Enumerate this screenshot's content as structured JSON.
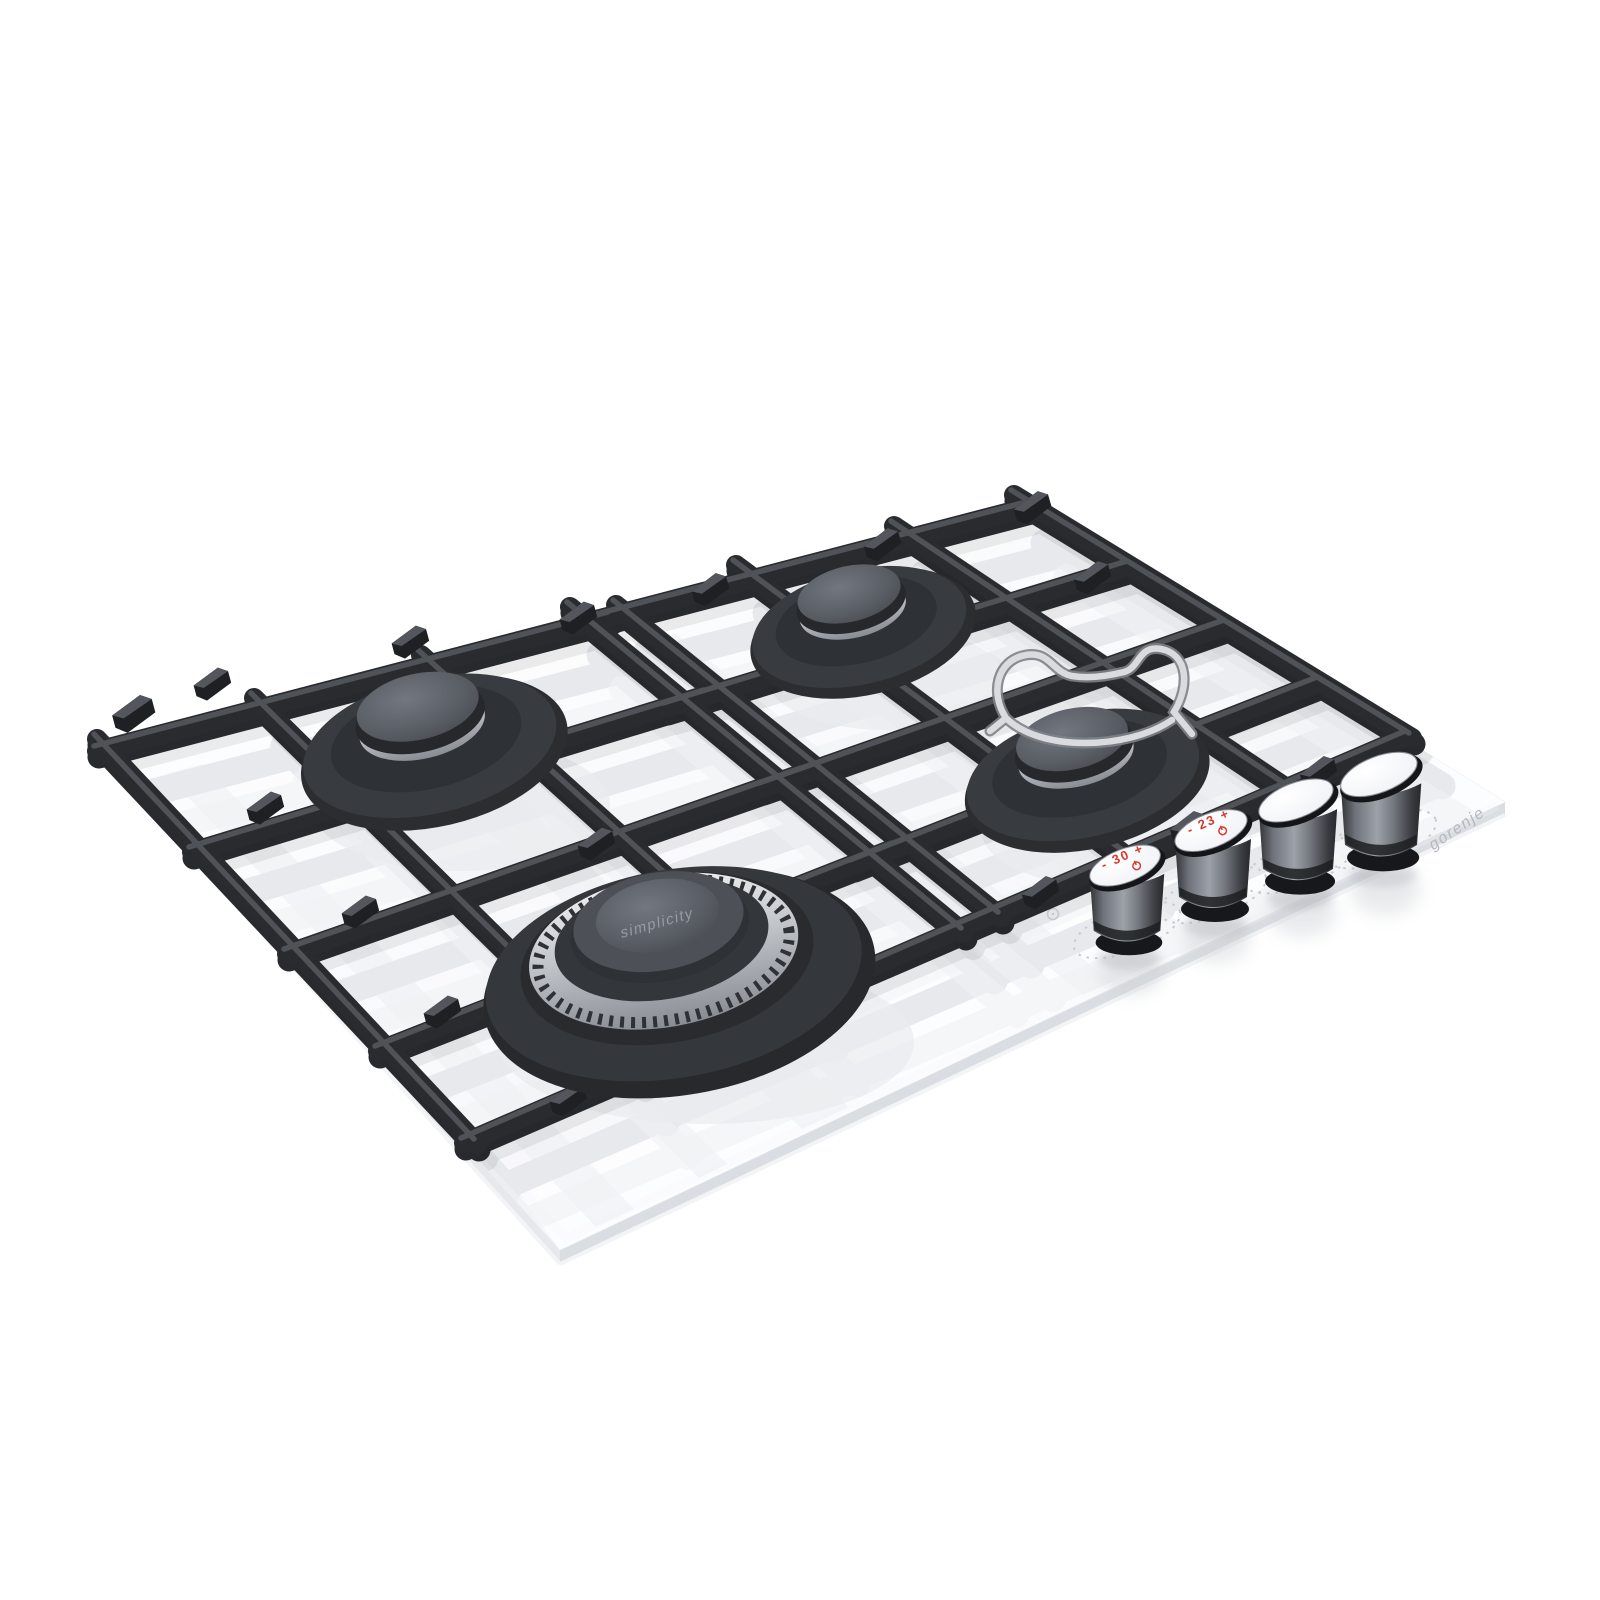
{
  "product": {
    "description": "built-in 4-burner gas hob on white glass, 3D product render",
    "brand_logo_text": "gorenje",
    "wok_burner_cap_text": "simplicity"
  },
  "controls": {
    "knob_count": 4,
    "knob1_marking": "- 30 +",
    "knob2_marking": "- 23 +",
    "marking_color": "#d93a30",
    "knob_icons": [
      "power-icon",
      "power-icon"
    ]
  },
  "scene": {
    "burners": [
      "semi-rapid-left",
      "auxiliary-back",
      "rapid-right-with-wire-trivet",
      "wok-front"
    ],
    "pan_supports": "black cast iron, two sections",
    "glass_color": "#f7f8fa",
    "grate_color": "#2a2c30",
    "silver_color": "#c6c9ce",
    "background": "#ffffff"
  }
}
